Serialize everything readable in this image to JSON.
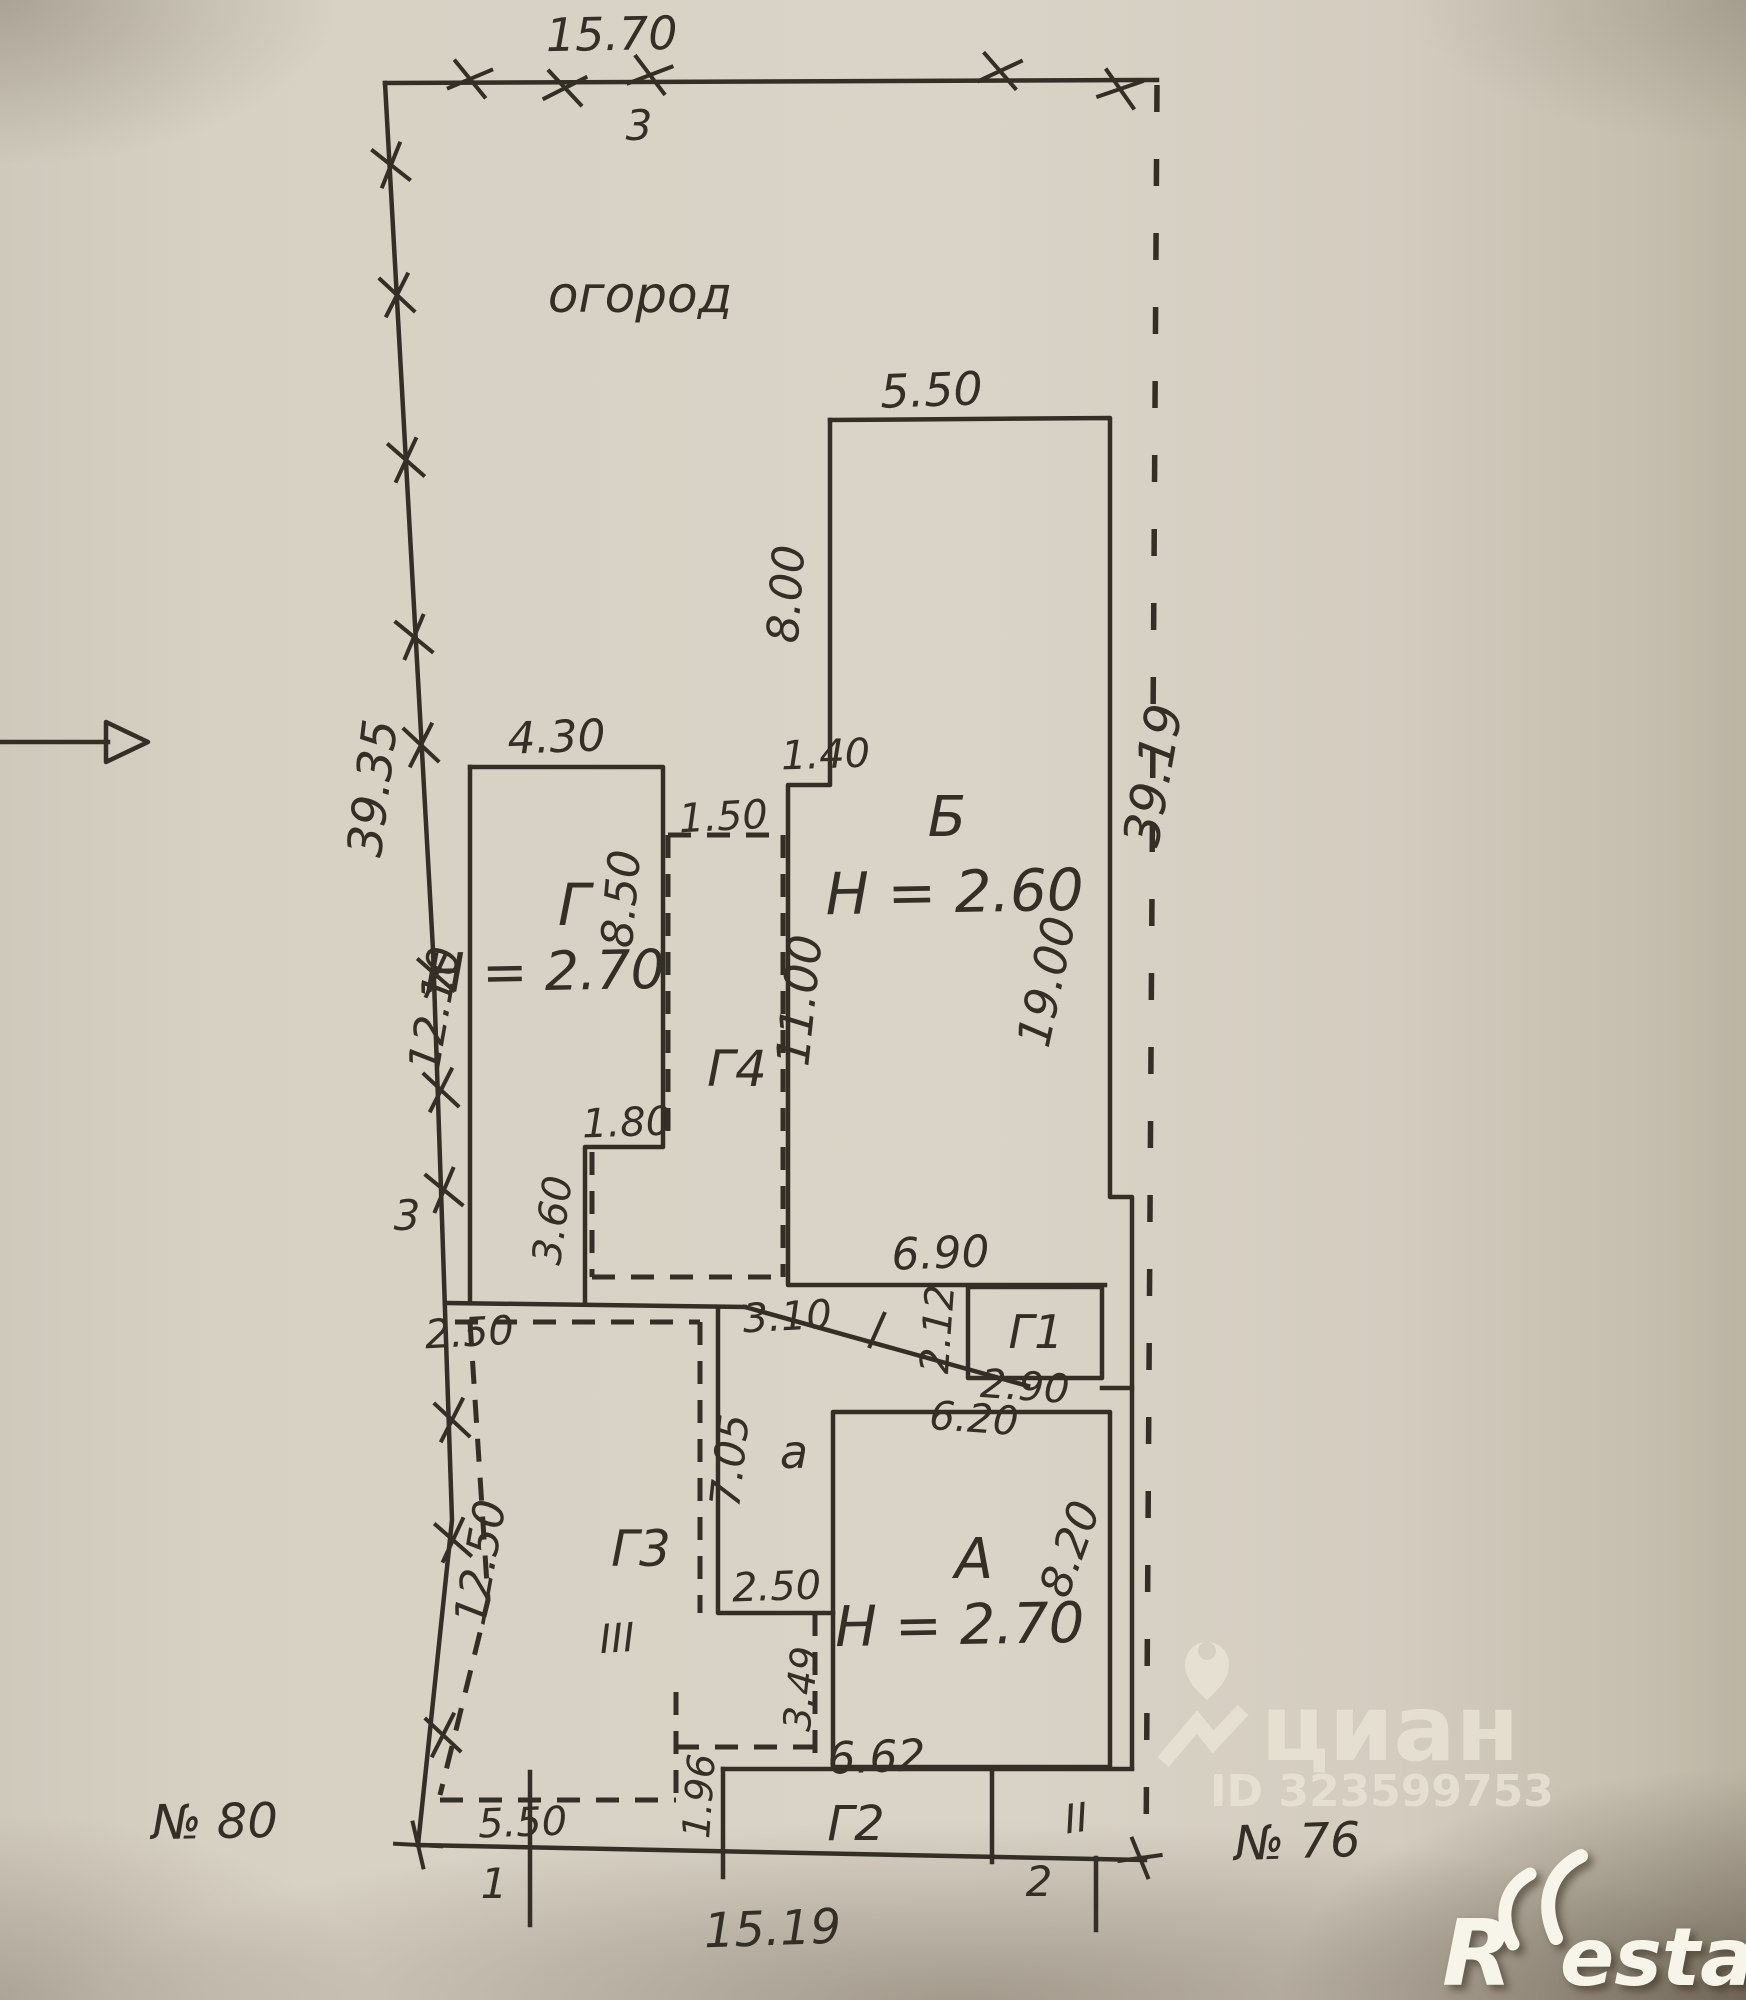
{
  "colors": {
    "ink": "#332f27",
    "paper": "#d8d2c6",
    "watermark": "#e9e4d5"
  },
  "boundary": {
    "top": "15.70",
    "left": "39.35",
    "right": "39.19",
    "bottom": "15.19",
    "garden": "огород",
    "point_top": "3",
    "point_left": "3",
    "point_1": "1",
    "point_2": "2",
    "neighbor_left": "№ 80",
    "neighbor_right": "№ 76"
  },
  "building_b": {
    "letter": "Б",
    "height": "Н = 2.60",
    "top": "5.50",
    "top_left": "8.00",
    "offset": "1.40",
    "left": "11.00",
    "right": "19.00",
    "bottom": "6.90"
  },
  "building_g": {
    "letter": "Г",
    "height": "Н = 2.70",
    "top": "4.30",
    "right": "8.50",
    "step_w": "1.80",
    "step_h": "3.60",
    "left_gap": "12.10"
  },
  "building_g4": {
    "letter": "Г4",
    "top": "1.50"
  },
  "building_g1": {
    "letter": "Г1",
    "left": "2.12",
    "bottom": "2.90",
    "gap": "3.10"
  },
  "building_a": {
    "letter": "А",
    "height": "Н = 2.70",
    "top": "6.20",
    "right": "8.20",
    "bottom": "6.62"
  },
  "porch": {
    "letter": "а",
    "left": "7.05",
    "bottom": "2.50",
    "step": "3.49"
  },
  "building_g2": {
    "letter": "Г2",
    "left": "1.96"
  },
  "building_g3": {
    "letter": "Г3",
    "left": "12.50",
    "top": "2.50",
    "bottom": "5.50",
    "mark": "III"
  },
  "marks": {
    "ii": "II"
  },
  "watermarks": {
    "cian": "циан",
    "cian_id": "ID 323599753",
    "restate_r": "R",
    "restate_est": "estate"
  }
}
